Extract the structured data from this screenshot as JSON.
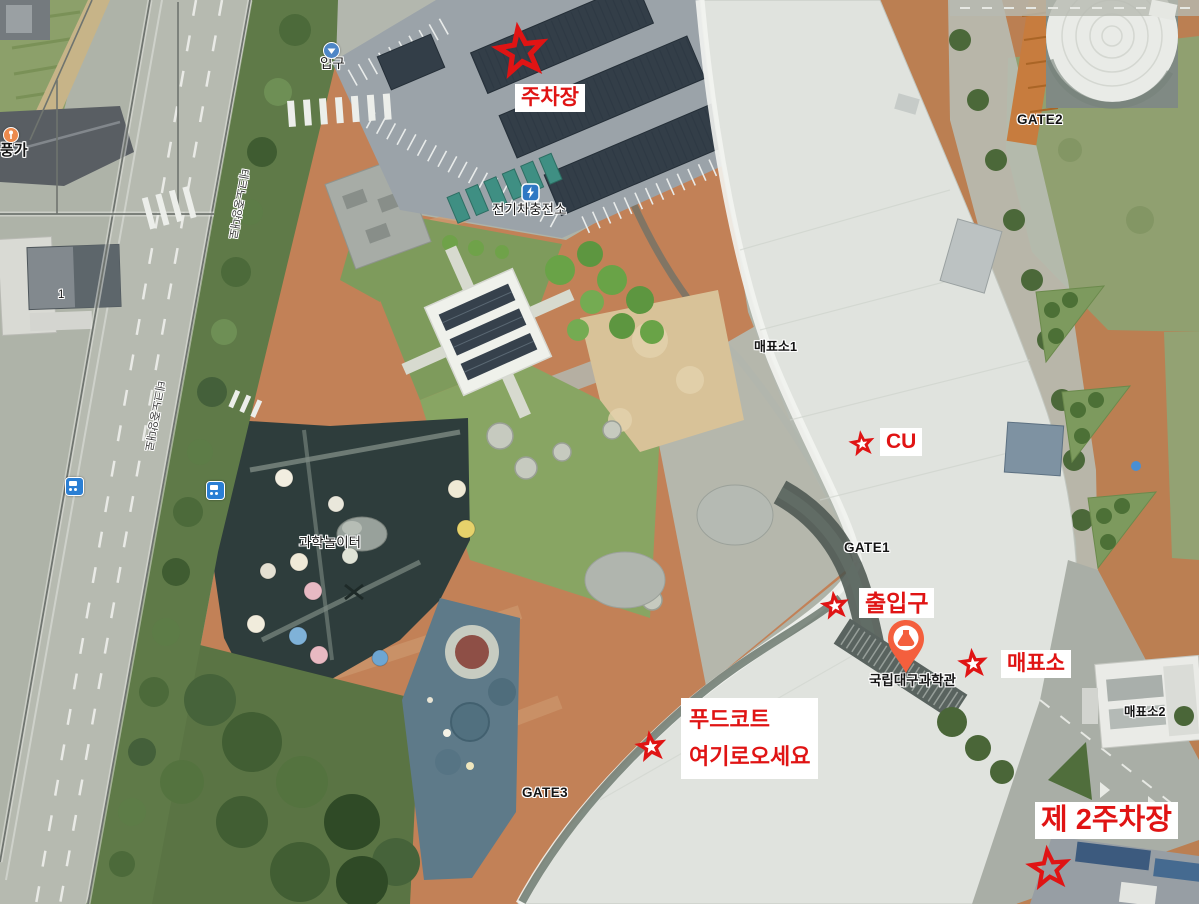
{
  "colors": {
    "annotation_red": "#e01414",
    "label_box_bg": "#ffffff",
    "map_label_text": "#141414",
    "museum_pin": "#f45f3d"
  },
  "annotations": {
    "parking": "주차장",
    "cu": "CU",
    "entrance": "출입구",
    "ticket_booth": "매표소",
    "foodcourt_line1": "푸드코트",
    "foodcourt_line2": "여기로오세요",
    "parking2": "제 2주차장"
  },
  "map_labels": {
    "entrance_gate": "입구",
    "ev_charging_station": "전기차충전소",
    "ticket_office_1": "매표소1",
    "gate1": "GATE1",
    "gate2": "GATE2",
    "gate3": "GATE3",
    "science_playground": "과학놀이터",
    "museum_name": "국립대구과학관",
    "ticket_office_2": "매표소2",
    "restaurant": "풍가",
    "building_number": "1",
    "road_name": "테크노중앙대로"
  }
}
